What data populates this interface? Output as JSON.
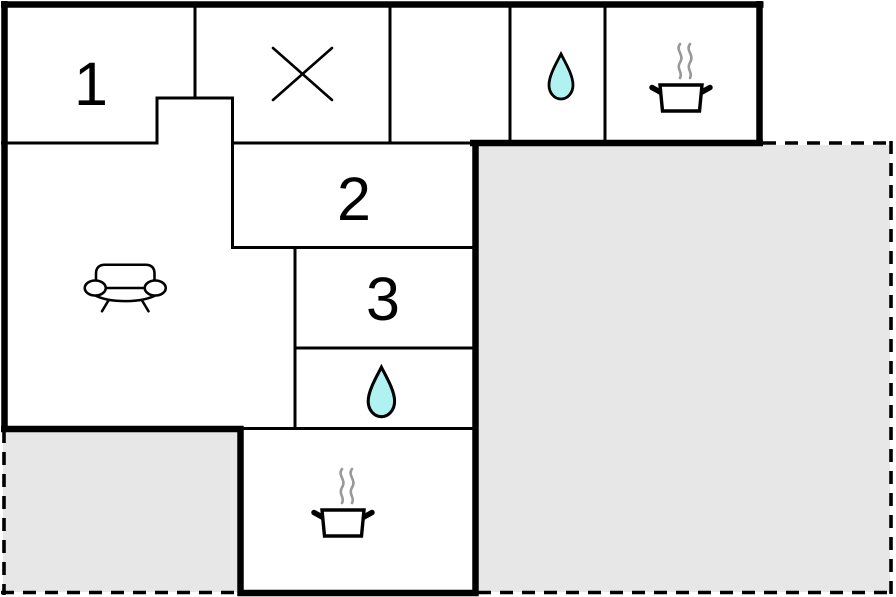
{
  "plan_type": "floor-plan-diagram",
  "background": "#ffffff",
  "colors": {
    "wall": "#000000",
    "terrace_fill": "#e7e7e7",
    "water_fill": "#b0f1f1",
    "steam": "#999999",
    "label": "#000000"
  },
  "rooms": {
    "room1": {
      "label": "1",
      "icon": null
    },
    "room_cross": {
      "label": "",
      "icon": "cross-icon"
    },
    "room_empty": {
      "label": "",
      "icon": null
    },
    "bathroom_top": {
      "label": "",
      "icon": "water-drop-icon"
    },
    "kitchen_top": {
      "label": "",
      "icon": "cooking-pot-icon"
    },
    "room2": {
      "label": "2",
      "icon": null
    },
    "room3": {
      "label": "3",
      "icon": null
    },
    "bathroom_middle": {
      "label": "",
      "icon": "water-drop-icon"
    },
    "living_room": {
      "label": "",
      "icon": "sofa-icon"
    },
    "kitchen": {
      "label": "",
      "icon": "cooking-pot-icon"
    },
    "terrace_right": {
      "label": "",
      "style": "gray-fill-dashed-outline"
    },
    "terrace_bottom_left": {
      "label": "",
      "style": "gray-fill-dashed-outline"
    }
  },
  "icons": {
    "water_drop": "water-drop-icon",
    "cooking_pot": "cooking-pot-icon",
    "sofa": "sofa-icon",
    "cross": "cross-icon"
  }
}
